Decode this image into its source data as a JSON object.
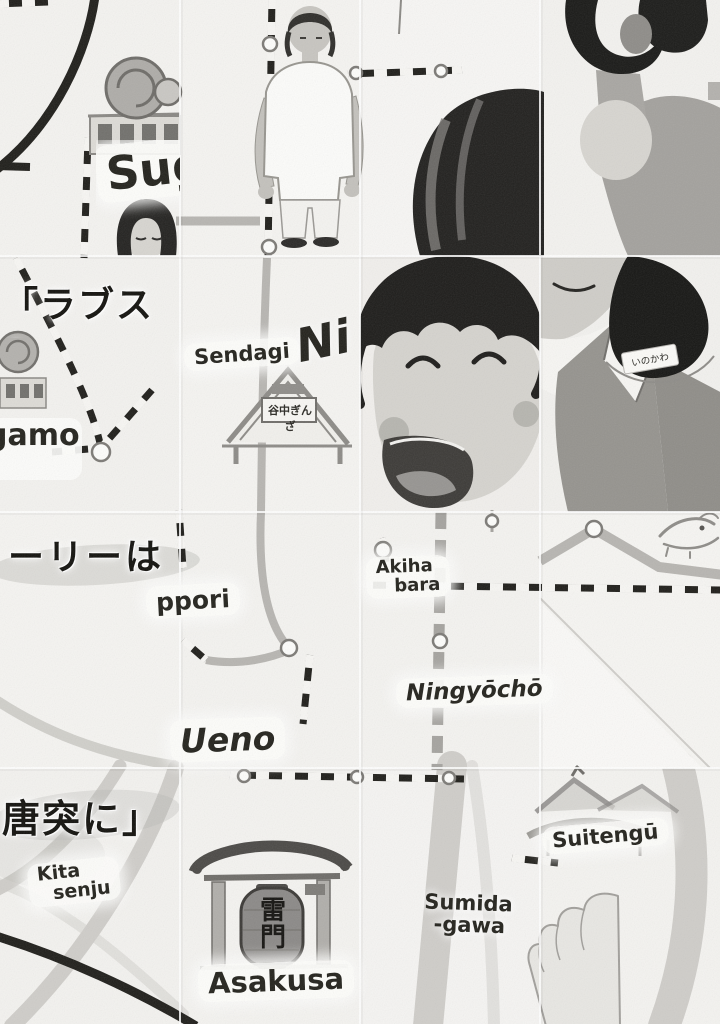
{
  "phrase": {
    "line1": "「ラブスト",
    "line2": "ーリーは",
    "line3": "唐突に」"
  },
  "stations": {
    "sugamo_top": "Sug",
    "sugamo": "gamo",
    "sendagi": "Sendagi",
    "nippori_top": "Ni",
    "nippori": "ppori",
    "akihabara": {
      "line1": "Akiha",
      "line2": "bara"
    },
    "ningyocho": "Ningyōchō",
    "ueno": "Ueno",
    "kita_senju": {
      "line1": "Kita",
      "line2": "senju"
    },
    "asakusa": "Asakusa",
    "sumida_gawa": {
      "line1": "Sumida",
      "line2": "-gawa"
    },
    "suitengu": "Suitengū"
  },
  "landmarks": {
    "yanaka_ginza_sign": "谷中ぎんざ",
    "kaminarimon_lantern": "雷門",
    "name_tag": "いのかわ"
  },
  "colors": {
    "paper": "#f3f2ef",
    "ink": "#1f1e1a",
    "rail_gray": "#a5a39f",
    "river_gray": "#cfcdc9",
    "hair_black": "#1d1c1a",
    "skin_gray": "#d5d3ce",
    "vest_gray": "#95938e"
  }
}
